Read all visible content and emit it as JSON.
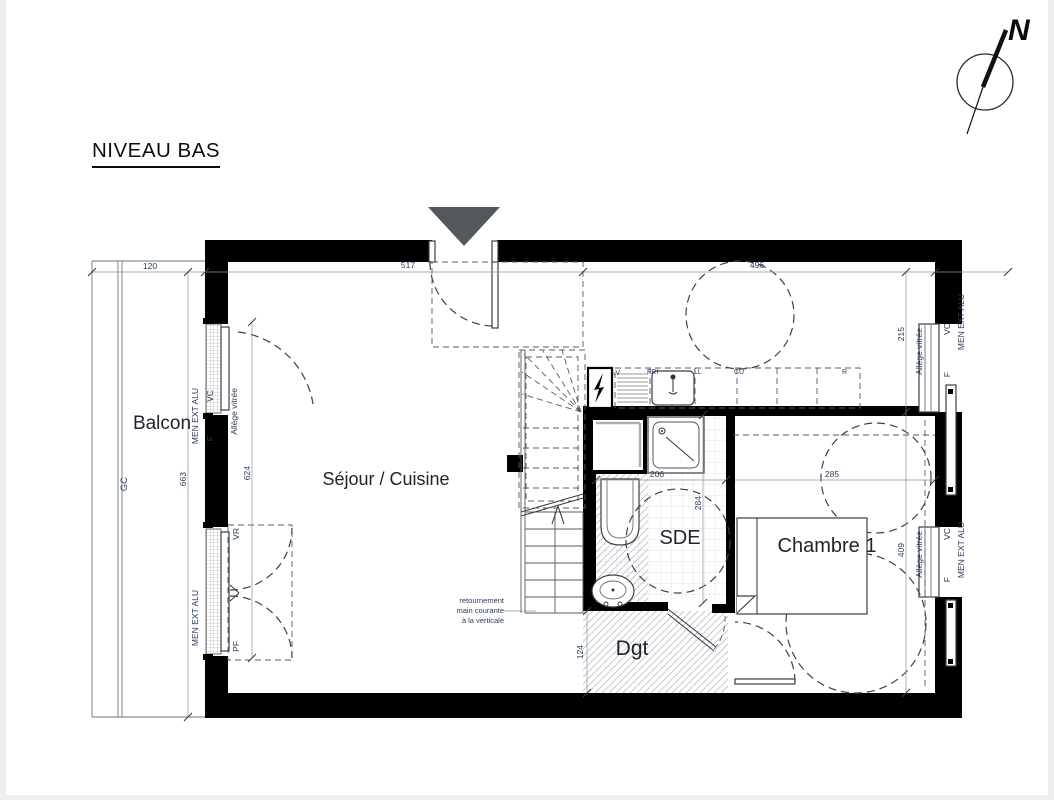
{
  "title": "NIVEAU BAS",
  "compass": {
    "north": "N"
  },
  "rooms": {
    "balcon": "Balcon",
    "sejour": "Séjour / Cuisine",
    "sde": "SDE",
    "chambre": "Chambre 1",
    "dgt": "Dgt"
  },
  "dims": {
    "d120": "120",
    "d517": "517",
    "d496": "496",
    "d663": "663",
    "d624": "624",
    "d215": "215",
    "d409": "409",
    "d285": "285",
    "d206": "206",
    "d284": "284",
    "d124": "124"
  },
  "labels": {
    "gc": "GC",
    "men_ext_alu": "MEN EXT ALU",
    "f": "F",
    "vc": "VC",
    "vr": "VR",
    "pf": "PF",
    "allege_vitree": "Allège vitrée",
    "note_1": "retournement",
    "note_2": "main courante",
    "note_3": "à la verticale"
  },
  "kitchen": {
    "lv": "LV",
    "fri": "FRI",
    "ll": "LL",
    "cu": "CU",
    "r": "R"
  },
  "colors": {
    "wall": "#000000",
    "triangle": "#54585c",
    "dashed": "#3c4248",
    "dim_text": "#2b3a5c",
    "room_text": "#20242c",
    "hatch": "#b9c0c8",
    "tile": "#d9dde2"
  }
}
